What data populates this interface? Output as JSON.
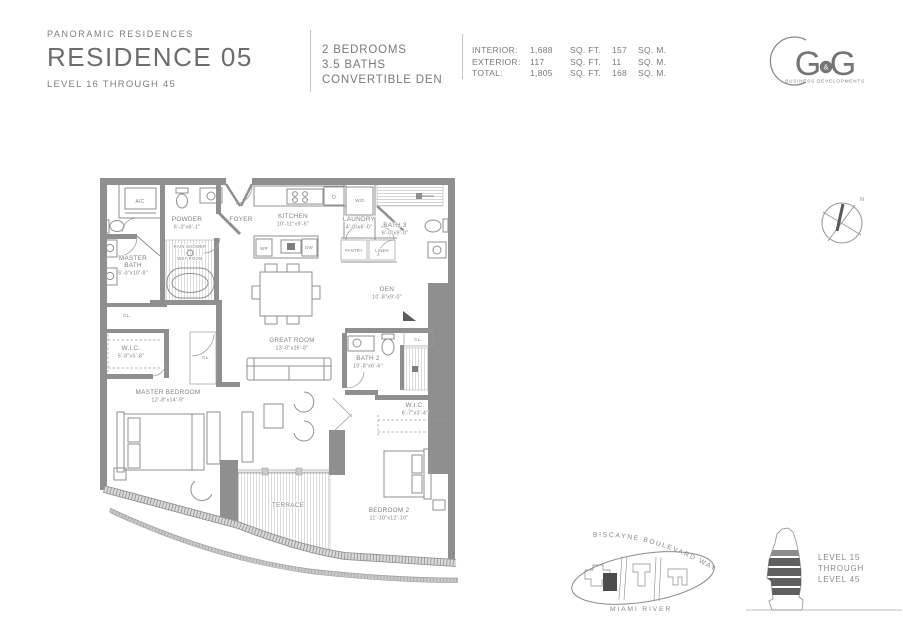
{
  "header": {
    "brand": "PANORAMIC RESIDENCES",
    "residence": "RESIDENCE 05",
    "levels": "LEVEL 16 THROUGH 45",
    "unit_features": [
      "2 BEDROOMS",
      "3.5 BATHS",
      "CONVERTIBLE DEN"
    ],
    "areas": {
      "rows": [
        {
          "label": "INTERIOR:",
          "sqft": "1,688",
          "sqft_unit": "SQ. FT.",
          "sqm": "157",
          "sqm_unit": "SQ. M."
        },
        {
          "label": "EXTERIOR:",
          "sqft": "117",
          "sqft_unit": "SQ. FT.",
          "sqm": "11",
          "sqm_unit": "SQ. M."
        },
        {
          "label": "TOTAL:",
          "sqft": "1,805",
          "sqft_unit": "SQ. FT.",
          "sqm": "168",
          "sqm_unit": "SQ. M."
        }
      ]
    }
  },
  "logo": {
    "g1": "G",
    "amp": "&",
    "g2": "G",
    "tagline": "BUSINESS DEVELOPMENTS"
  },
  "compass": {
    "north": "N"
  },
  "floorplan": {
    "rooms": [
      {
        "name": "POWDER",
        "dims": "6'-3\"x6'-1\"",
        "x": 187,
        "y": 221
      },
      {
        "name": "FOYER",
        "dims": "",
        "x": 241,
        "y": 221
      },
      {
        "name": "KITCHEN",
        "dims": "10'-11\"x9'-6\"",
        "x": 293,
        "y": 218
      },
      {
        "name": "LAUNDRY",
        "dims": "4'-0\"x6'-0\"",
        "x": 359,
        "y": 221
      },
      {
        "name": "BATH 3",
        "dims": "6'-0\"x9'-0\"",
        "x": 395,
        "y": 227
      },
      {
        "name": "MASTER\nBATH",
        "dims": "6'-0\"x10'-8\"",
        "x": 133,
        "y": 260
      },
      {
        "name": "DEN",
        "dims": "10'-8\"x9'-0\"",
        "x": 387,
        "y": 291
      },
      {
        "name": "W.I.C.",
        "dims": "5'-8\"x5'-8\"",
        "x": 131,
        "y": 350
      },
      {
        "name": "GREAT ROOM",
        "dims": "13'-0\"x26'-8\"",
        "x": 292,
        "y": 342
      },
      {
        "name": "BATH 2",
        "dims": "10'-8\"x6'-6\"",
        "x": 368,
        "y": 360
      },
      {
        "name": "MASTER BEDROOM",
        "dims": "12'-8\"x14'-9\"",
        "x": 168,
        "y": 394
      },
      {
        "name": "W.I.C.",
        "dims": "6'-7\"x3'-4\"",
        "x": 415,
        "y": 407
      },
      {
        "name": "TERRACE",
        "dims": "",
        "x": 288,
        "y": 507
      },
      {
        "name": "BEDROOM 2",
        "dims": "11'-10\"x12'-10\"",
        "x": 389,
        "y": 512
      }
    ],
    "labels": [
      {
        "t": "A/C",
        "x": 140,
        "y": 203,
        "s": 5
      },
      {
        "t": "O",
        "x": 334,
        "y": 199,
        "s": 5
      },
      {
        "t": "W/D",
        "x": 360,
        "y": 202,
        "s": 4.5
      },
      {
        "t": "WR",
        "x": 264,
        "y": 250,
        "s": 4.5
      },
      {
        "t": "DW",
        "x": 309,
        "y": 249,
        "s": 4.5
      },
      {
        "t": "PANTRY",
        "x": 354,
        "y": 252,
        "s": 4.2
      },
      {
        "t": "LINEN",
        "x": 382,
        "y": 252,
        "s": 4.2
      },
      {
        "t": "RAIN SHOWER",
        "x": 190,
        "y": 248,
        "s": 4.2
      },
      {
        "t": "WET ROOM",
        "x": 190,
        "y": 260,
        "s": 4.2
      },
      {
        "t": "CL.",
        "x": 127,
        "y": 317,
        "s": 4.5
      },
      {
        "t": "CL.",
        "x": 206,
        "y": 359,
        "s": 4.5
      },
      {
        "t": "CL.",
        "x": 418,
        "y": 341,
        "s": 4.5
      }
    ]
  },
  "siteplan": {
    "street": "BISCAYNE BOULEVARD WAY",
    "river": "MIAMI RIVER"
  },
  "stack": {
    "lines": [
      "LEVEL 15",
      "THROUGH",
      "LEVEL 45"
    ]
  },
  "colors": {
    "wall": "#8f8f8f",
    "text": "#7d7d7d",
    "dark": "#4f4f4f"
  }
}
